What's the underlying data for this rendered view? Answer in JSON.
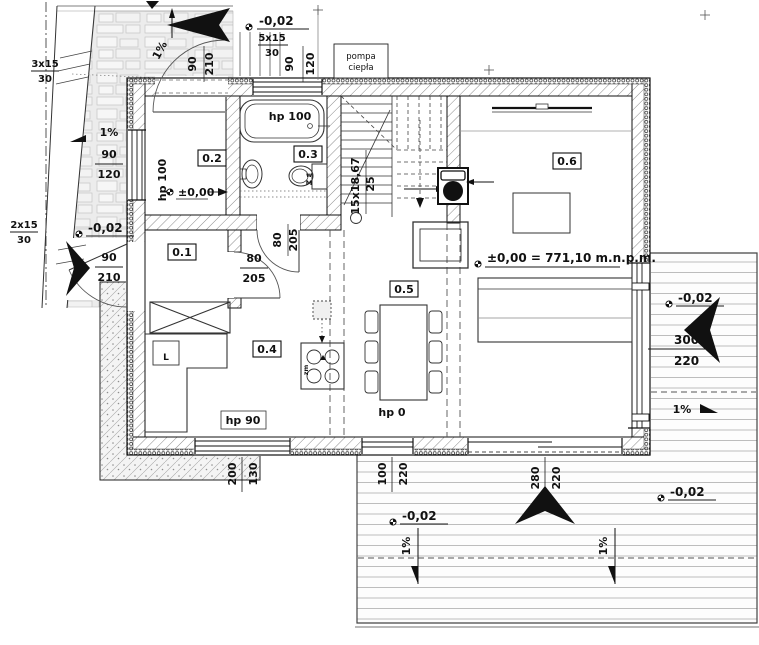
{
  "plan": {
    "rooms": {
      "r01": "0.1",
      "r02": "0.2",
      "r03": "0.3",
      "r04": "0.4",
      "r05": "0.5",
      "r06": "0.6"
    },
    "levels": {
      "zero": "±0,00",
      "zero_full": "±0,00 = 771,10 m.n.p.m.",
      "minus": "-0,02"
    },
    "slope": "1%",
    "stairs": {
      "flight": "15x18,67",
      "flight_width": "25",
      "ext_top_count": "3x15",
      "ext_top_h": "30",
      "ext_left_count": "2x15",
      "ext_left_h": "30",
      "ext_back_count": "5x15",
      "ext_back_h": "30"
    },
    "equipment": {
      "heat_pump_line1": "pompa",
      "heat_pump_line2": "ciepła",
      "dishwasher": "L",
      "sink": "zm",
      "wc_line1": "w",
      "wc_line2": "M"
    },
    "sills": {
      "hp100": "hp 100",
      "hp90": "hp 90",
      "hp0": "hp 0"
    },
    "dims": {
      "d90": "90",
      "d120": "120",
      "d210": "210",
      "d80": "80",
      "d205": "205",
      "d200": "200",
      "d130": "130",
      "d100": "100",
      "d220": "220",
      "d280": "280",
      "d300": "300"
    },
    "colors": {
      "line": "#1a1a1a",
      "deck_line": "#bdbdbd",
      "wall_hatch": "#8a8a8a"
    }
  }
}
